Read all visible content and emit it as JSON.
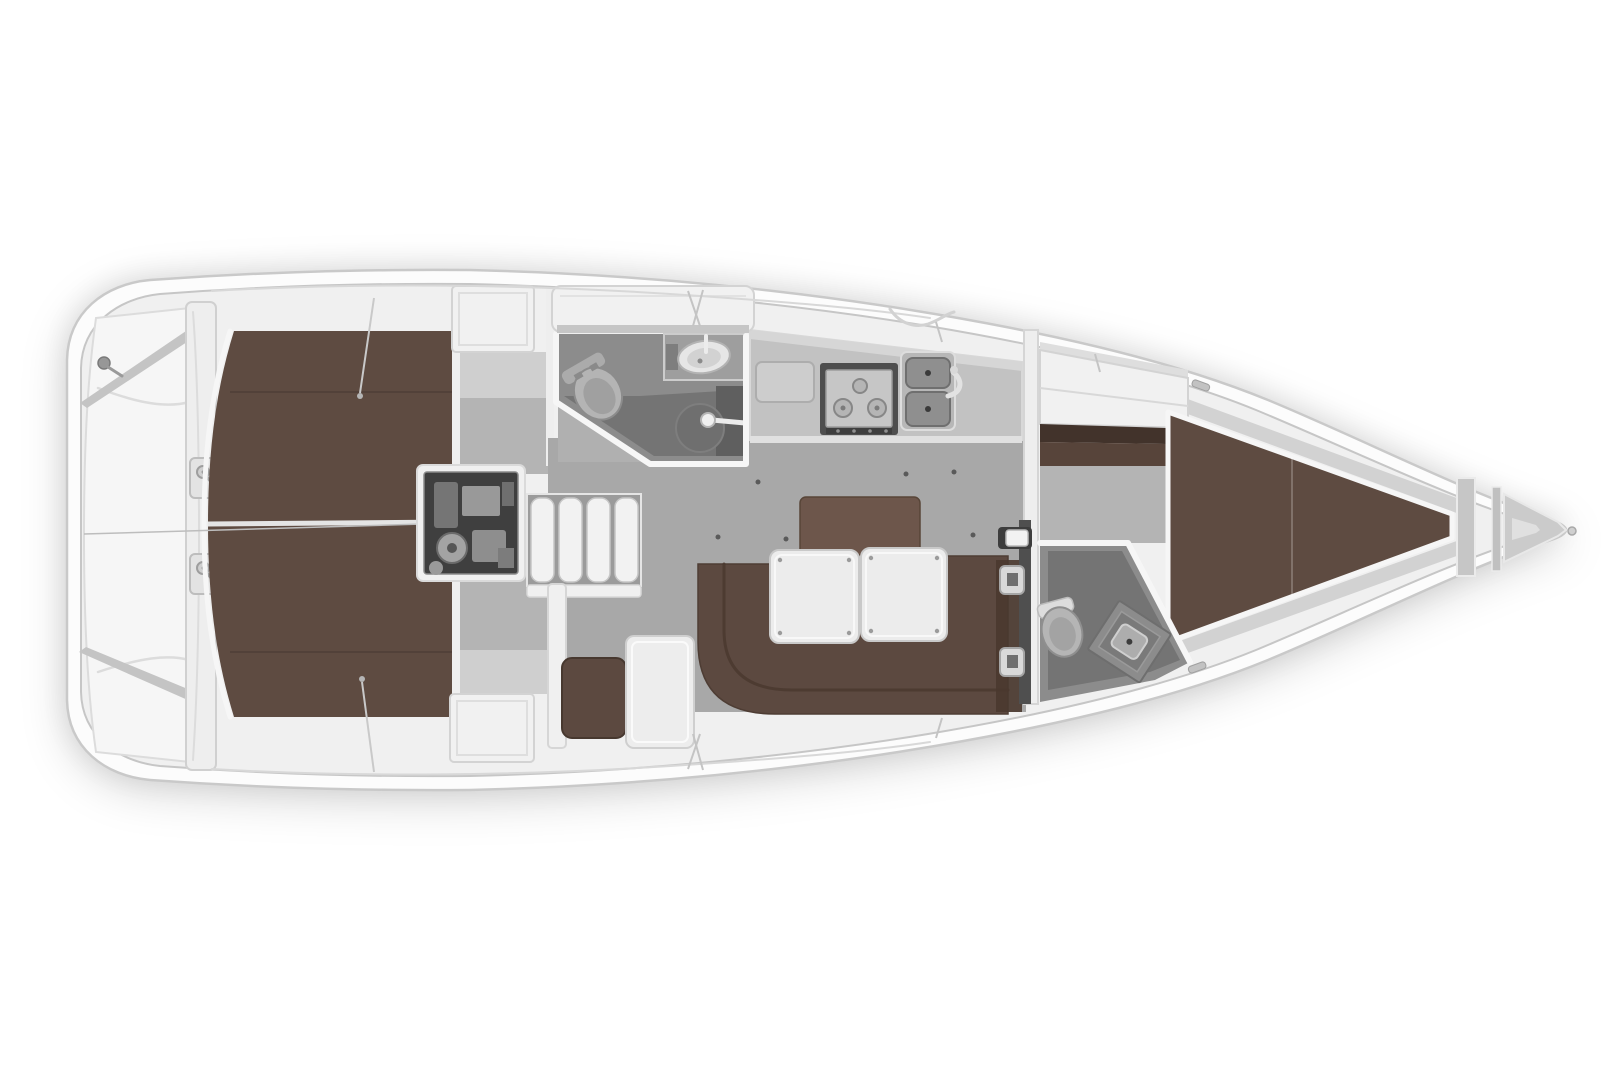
{
  "diagram": {
    "label": "Sailing yacht interior floor plan, top view, bow pointing right",
    "type": "boat-floor-plan",
    "orientation": {
      "bow": "right",
      "stern": "left",
      "port": "top",
      "starboard": "bottom"
    },
    "rooms": [
      {
        "id": "transom-stowage"
      },
      {
        "id": "aft-cabin-port"
      },
      {
        "id": "aft-cabin-starboard"
      },
      {
        "id": "engine-compartment"
      },
      {
        "id": "companionway-steps"
      },
      {
        "id": "aft-heads"
      },
      {
        "id": "galley"
      },
      {
        "id": "saloon"
      },
      {
        "id": "forward-heads"
      },
      {
        "id": "forward-cabin"
      },
      {
        "id": "anchor-locker"
      }
    ]
  },
  "palette": {
    "page_bg": "#ffffff",
    "hull_fill": "#fcfcfc",
    "hull_stroke": "#c9c9c9",
    "deck_fill": "#f0f0f0",
    "deck_stroke": "#c6c6c6",
    "panel_white": "#f1f1f1",
    "panel_stroke": "#d3d3d3",
    "trim_white": "#f6f6f6",
    "strip_gray": "#c4c4c4",
    "wall_white": "#eeeeee",
    "floor_light": "#cfcfcf",
    "floor_mid": "#b4b4b4",
    "floor_saloon": "#a8a8a8",
    "heads_floor": "#8c8c8c",
    "heads_floor_dark": "#747474",
    "heads_floor_darker": "#5e5e5e",
    "counter": "#c2c2c2",
    "counter_light": "#d6d6d6",
    "appliance_frame": "#4e4e4e",
    "appliance_face": "#c6c6c6",
    "basin_gray": "#8f8f8f",
    "engine_dark": "#3f3f3f",
    "engine_part": "#999999",
    "steps_gap": "#9b9b9b",
    "step_face": "#f2f2f2",
    "berth_brown": "#5e4b41",
    "wardrobe_dark": "#42332b",
    "wardrobe_mid": "#57443a",
    "settee_brown": "#5c4940",
    "settee_dark": "#4a382f",
    "backrest_brown": "#6d564b",
    "table_top": "#ececec",
    "fitting_gray": "#d9d9d9",
    "fitting_slot": "#6f6f6f",
    "dot_dark": "#5a5a5a",
    "toilet_gray": "#b5b5b5",
    "toilet_white": "#e8e8e8",
    "sink_white": "#e6e6e6",
    "metal": "#c9c9c9",
    "locker_gray": "#cbcbcb",
    "deck_band": "#d2d2d2"
  }
}
